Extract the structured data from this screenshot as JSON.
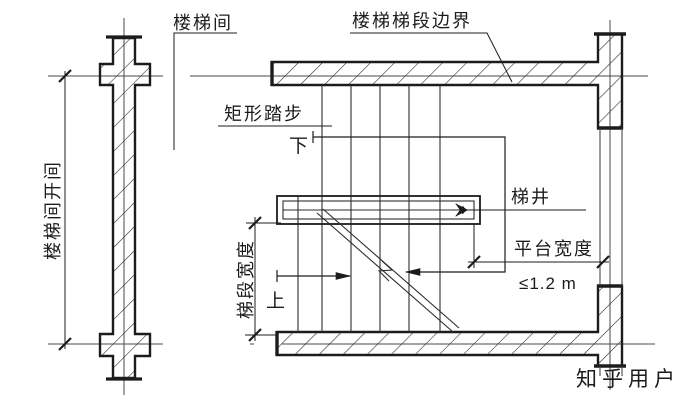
{
  "figure": {
    "type": "stair-plan-architectural-drawing",
    "labels": {
      "stairwell_room": "楼梯间",
      "flight_boundary": "楼梯梯段边界",
      "rectangular_tread": "矩形踏步",
      "down": "下",
      "up": "上",
      "stair_well": "梯井",
      "platform_width": "平台宽度",
      "platform_width_limit": "≤1.2 m",
      "flight_width": "梯段宽度",
      "bay_width": "楼梯间开间"
    },
    "watermark": "知乎用户",
    "colors": {
      "ink": "#1c1c1c",
      "thin_line": "#3a3a3a",
      "watermark": "#c4c4c4",
      "paper": "#ffffff"
    }
  }
}
